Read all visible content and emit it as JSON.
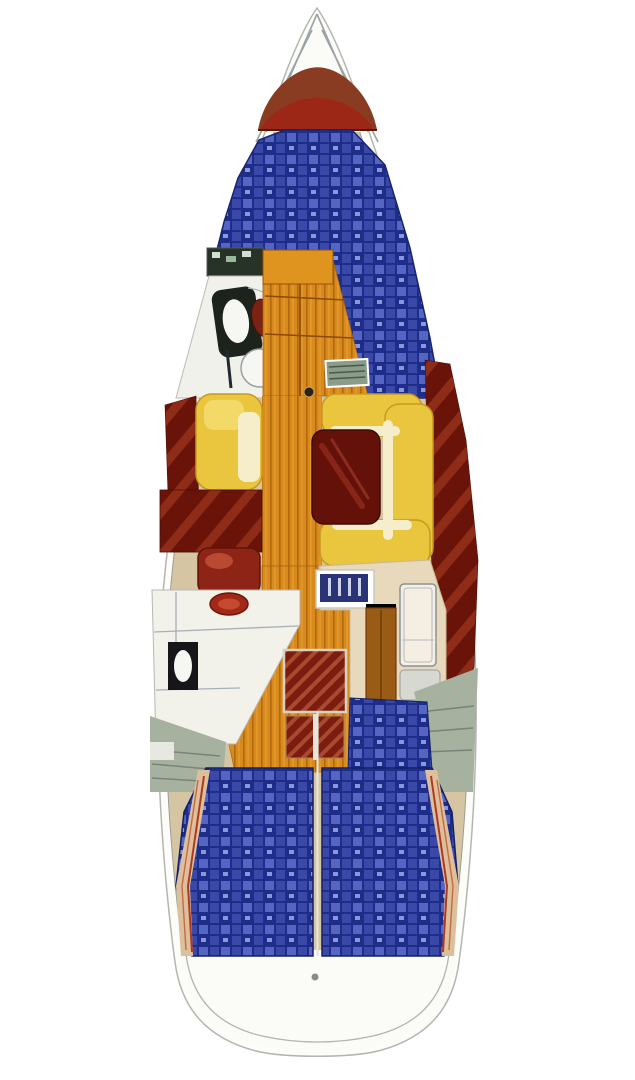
{
  "figure": {
    "kind": "sailboat-interior-layout-plan",
    "orientation": "bow-up",
    "regions": [
      "anchor-locker",
      "bow-hatch",
      "v-berth",
      "forward-head",
      "wood-passage",
      "port-settee",
      "starboard-u-settee",
      "salon-table",
      "galley",
      "nav-station",
      "companionway-steps",
      "engine-area",
      "port-aft-berth",
      "starboard-aft-berth",
      "stern"
    ]
  },
  "colors": {
    "page_bg": "#ffffff",
    "hull_fill": "#fcfcf9",
    "hull_line": "#b5b5b0",
    "liner_tan": "#d6c5a2",
    "forepeak_white": "#fbfbf8",
    "bow_brown": "#8a3c22",
    "bow_red": "#9c2716",
    "berth_dark": "#1f2d8a",
    "berth_mid": "#3a49a8",
    "berth_light": "#5565c2",
    "berth_fleck": "#8b97d8",
    "wood": "#d88a1c",
    "wood_dark": "#b2680e",
    "wood_light": "#e8a235",
    "wood_cab": "#df9420",
    "settee_yellow": "#eac53e",
    "settee_cream": "#f6eecb",
    "settee_edge": "#c79a1f",
    "settee_hi": "#f2d968",
    "table_maroon": "#641109",
    "table_streak": "#9c3423",
    "hull_maroon": "#691309",
    "maroon_light": "#8e2c18",
    "head_white": "#f1f1ec",
    "fixture_dark": "#1c221c",
    "toilet_white": "#f6f6f2",
    "wc_oval_red": "#7c2214",
    "stove_red": "#8e2416",
    "stove_hi": "#b84a32",
    "sink_red": "#a22818",
    "sink_red_hi": "#c44a30",
    "galley_white": "#f2f1ea",
    "black_appliance": "#15151a",
    "nav_beige": "#e8d9bd",
    "nav_beige_line": "#c8b894",
    "cabinet_brown": "#9a5c14",
    "cabinet_brown_dark": "#6e3c08",
    "chart_white": "#f4efe2",
    "panel_blue": "#2a3376",
    "panel_tick": "#cdd2e8",
    "gray_box": "#d8d8d2",
    "engine_green": "#a7b1a0",
    "engine_line": "#78847a",
    "shelf_green": "#8c9c8a",
    "shelf_green_dark": "#4a5a48",
    "shelf_dark": "#263326",
    "steps_red": "#7c1c0e",
    "steps_light": "#a84a30",
    "shelf_tan": "#dcbf9c",
    "shelf_red_line": "#b03a20",
    "divider_white": "#e8e4dc",
    "mast_dark": "#2a2118"
  }
}
